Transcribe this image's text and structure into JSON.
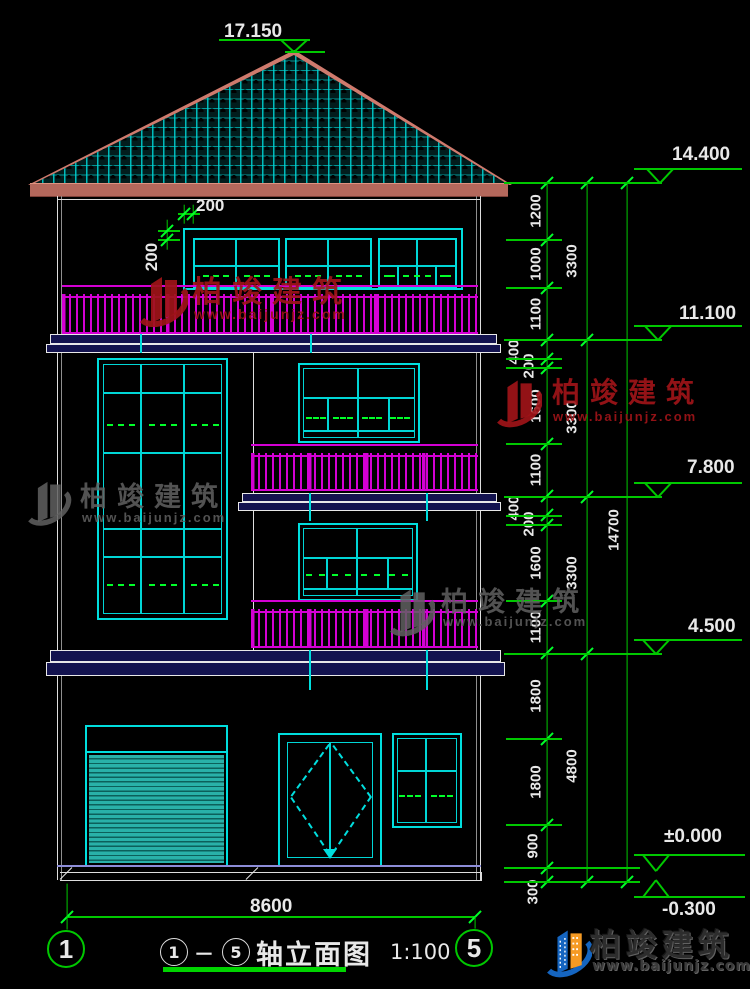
{
  "title": {
    "start": "1",
    "dash": "－",
    "end": "5",
    "text": "轴立面图",
    "scale": "1:100"
  },
  "watermark": {
    "text": "柏竣建筑",
    "url": "www.baijunjz.com"
  },
  "logo": {
    "text": "柏竣建筑",
    "url": "www.baijunjz.com"
  },
  "palette": {
    "cyan": "#00dede",
    "green": "#00c800",
    "bright_green": "#00ff2a",
    "magenta": "#d400d4",
    "white": "#e8e8e8",
    "salmon": "#cf7a6d",
    "navy": "#13134f",
    "ground_blue": "#8d8dd8",
    "wm_red": "rgba(158,20,24,0.92)",
    "wm_gray": "rgba(96,96,96,0.85)",
    "logo_blue": "#1565c0",
    "logo_orange": "#f59a23"
  },
  "drawing": {
    "elevation_markers": [
      {
        "label": "17.150",
        "tx": 224,
        "ty": 21,
        "bx1": 219,
        "bx2": 310,
        "by": 40,
        "vc": 294,
        "vy1": 40,
        "vy2": 52,
        "ax1": 285,
        "ax2": 325
      },
      {
        "label": "14.400",
        "tx": 672,
        "ty": 144,
        "bx1": 634,
        "bx2": 742,
        "by": 169,
        "vc": 660,
        "vy1": 169,
        "vy2": 183
      },
      {
        "label": "11.100",
        "tx": 679,
        "ty": 303,
        "bx1": 634,
        "bx2": 742,
        "by": 326,
        "vc": 658,
        "vy1": 326,
        "vy2": 340
      },
      {
        "label": "7.800",
        "tx": 687,
        "ty": 457,
        "bx1": 634,
        "bx2": 742,
        "by": 483,
        "vc": 658,
        "vy1": 483,
        "vy2": 497
      },
      {
        "label": "4.500",
        "tx": 688,
        "ty": 616,
        "bx1": 634,
        "bx2": 742,
        "by": 640,
        "vc": 656,
        "vy1": 640,
        "vy2": 654
      },
      {
        "label": "±0.000",
        "tx": 664,
        "ty": 826,
        "bx1": 634,
        "bx2": 745,
        "by": 855,
        "vc": 656,
        "vy1": 855,
        "vy2": 871
      },
      {
        "label": "-0.300",
        "tx": 662,
        "ty": 899,
        "bx1": 634,
        "bx2": 745,
        "by": 897,
        "vc": 656,
        "vy1": 897,
        "vy2": 880
      }
    ],
    "chains": [
      {
        "x": 547,
        "y1": 183,
        "y2": 882,
        "label_dx": -11,
        "ticks": [
          183,
          240,
          288,
          340,
          359,
          368,
          444,
          496,
          515,
          525,
          601,
          653,
          739,
          825,
          868,
          882
        ],
        "labels": [
          {
            "t": "1200",
            "y": 211
          },
          {
            "t": "1000",
            "y": 264
          },
          {
            "t": "1100",
            "y": 314
          },
          {
            "t": "400",
            "y": 352,
            "dx": -22
          },
          {
            "t": "200",
            "y": 366,
            "dx": -7
          },
          {
            "t": "1600",
            "y": 406
          },
          {
            "t": "1100",
            "y": 470
          },
          {
            "t": "400",
            "y": 508,
            "dx": -22
          },
          {
            "t": "200",
            "y": 524,
            "dx": -7
          },
          {
            "t": "1600",
            "y": 563
          },
          {
            "t": "1100",
            "y": 627
          },
          {
            "t": "1800",
            "y": 696
          },
          {
            "t": "1800",
            "y": 782
          },
          {
            "t": "900",
            "y": 846,
            "dx": -3
          },
          {
            "t": "300",
            "y": 892,
            "dx": -3
          }
        ]
      },
      {
        "x": 587,
        "y1": 183,
        "y2": 882,
        "label_dx": -15,
        "ticks": [
          183,
          340,
          497,
          654,
          882
        ],
        "labels": [
          {
            "t": "3300",
            "y": 261
          },
          {
            "t": "3300",
            "y": 417
          },
          {
            "t": "3300",
            "y": 573
          },
          {
            "t": "4800",
            "y": 766
          }
        ]
      },
      {
        "x": 627,
        "y1": 183,
        "y2": 882,
        "label_dx": -13,
        "ticks": [
          183,
          882
        ],
        "labels": [
          {
            "t": "14700",
            "y": 530
          }
        ]
      }
    ],
    "ext_lines": [
      {
        "y": 183,
        "x1": 504,
        "x2": 662
      },
      {
        "y": 240,
        "x1": 506,
        "x2": 562
      },
      {
        "y": 288,
        "x1": 506,
        "x2": 562
      },
      {
        "y": 340,
        "x1": 504,
        "x2": 662
      },
      {
        "y": 359,
        "x1": 506,
        "x2": 562
      },
      {
        "y": 368,
        "x1": 506,
        "x2": 562
      },
      {
        "y": 444,
        "x1": 506,
        "x2": 562
      },
      {
        "y": 497,
        "x1": 504,
        "x2": 662
      },
      {
        "y": 516,
        "x1": 506,
        "x2": 562
      },
      {
        "y": 525,
        "x1": 506,
        "x2": 562
      },
      {
        "y": 601,
        "x1": 506,
        "x2": 562
      },
      {
        "y": 654,
        "x1": 504,
        "x2": 662
      },
      {
        "y": 739,
        "x1": 506,
        "x2": 562
      },
      {
        "y": 825,
        "x1": 506,
        "x2": 562
      },
      {
        "y": 868,
        "x1": 504,
        "x2": 640
      },
      {
        "y": 882,
        "x1": 504,
        "x2": 640
      }
    ],
    "bottom_dim": {
      "label": "8600",
      "y": 917,
      "x1": 67,
      "x2": 475,
      "label_x": 250,
      "label_y": 896,
      "ext": [
        {
          "x": 67,
          "y1": 884,
          "y2": 930
        },
        {
          "x": 475,
          "y1": 917,
          "y2": 929
        }
      ]
    },
    "axis_bubbles": [
      {
        "n": "1",
        "cx": 66,
        "cy": 949,
        "r": 19
      },
      {
        "n": "5",
        "cx": 474,
        "cy": 948,
        "r": 19
      }
    ],
    "small_dims": [
      {
        "label": "200",
        "rot": false,
        "tx": 196,
        "ty": 196,
        "lines": [
          [
            184,
            205,
            184,
            224
          ],
          [
            193,
            205,
            193,
            224
          ],
          [
            178,
            214,
            200,
            214
          ]
        ],
        "ticks": [
          [
            184,
            214
          ],
          [
            193,
            214
          ]
        ]
      },
      {
        "label": "200",
        "rot": true,
        "tx": 152,
        "ty": 257,
        "lines": [
          [
            167,
            220,
            167,
            250
          ],
          [
            158,
            231,
            180,
            231
          ],
          [
            158,
            240,
            180,
            240
          ]
        ],
        "ticks": [
          [
            167,
            231
          ],
          [
            167,
            240
          ]
        ]
      }
    ],
    "ground_hatches": [
      [
        60,
        880,
        72,
        868
      ],
      [
        246,
        880,
        258,
        868
      ]
    ],
    "watermarks": [
      {
        "style": "red",
        "lx": 128,
        "ly": 268,
        "lw": 60,
        "lh": 64,
        "tx": 192,
        "ty": 267,
        "ts": 30,
        "ux": 194,
        "uy": 306,
        "us": 14
      },
      {
        "style": "red",
        "lx": 486,
        "ly": 371,
        "lw": 56,
        "lh": 62,
        "tx": 552,
        "ty": 371,
        "ts": 28,
        "ux": 553,
        "uy": 409,
        "us": 13
      },
      {
        "style": "gray",
        "lx": 16,
        "ly": 474,
        "lw": 56,
        "lh": 56,
        "tx": 80,
        "ty": 475,
        "ts": 27,
        "ux": 82,
        "uy": 510,
        "us": 13
      },
      {
        "style": "gray",
        "lx": 379,
        "ly": 581,
        "lw": 56,
        "lh": 60,
        "tx": 441,
        "ty": 580,
        "ts": 27,
        "ux": 443,
        "uy": 614,
        "us": 13
      }
    ]
  }
}
